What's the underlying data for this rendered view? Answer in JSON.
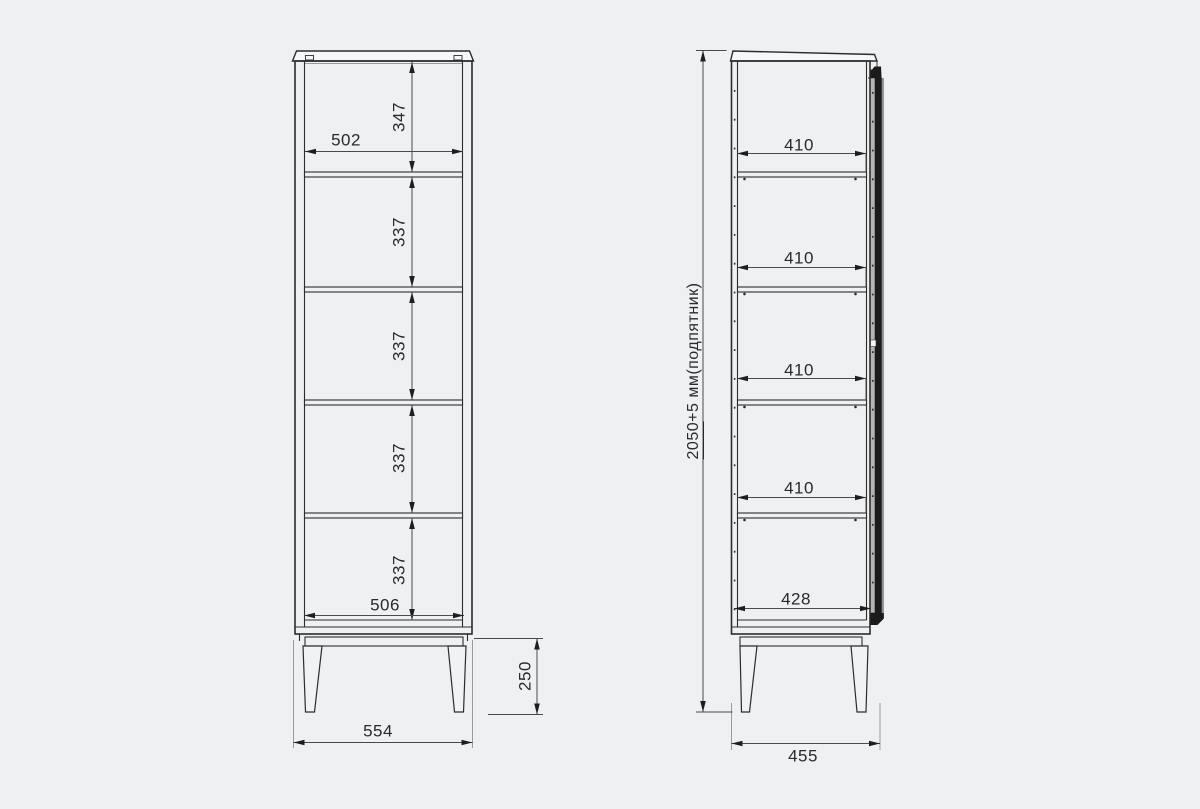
{
  "front_view": {
    "section_heights": [
      "347",
      "337",
      "337",
      "337",
      "337"
    ],
    "inner_width_top": "502",
    "inner_width_bottom": "506",
    "overall_width": "554",
    "leg_height": "250"
  },
  "side_view": {
    "shelf_depths": [
      "410",
      "410",
      "410",
      "410"
    ],
    "inner_depth_bottom": "428",
    "overall_depth": "455",
    "overall_height_main": "2050",
    "overall_height_suffix": "+5 мм(подпятник)"
  },
  "colors": {
    "background": "#eef0f1",
    "line": "#2c2c2c",
    "dimension_line": "#4a4a4a",
    "door_dark": "#1b1b1b"
  }
}
